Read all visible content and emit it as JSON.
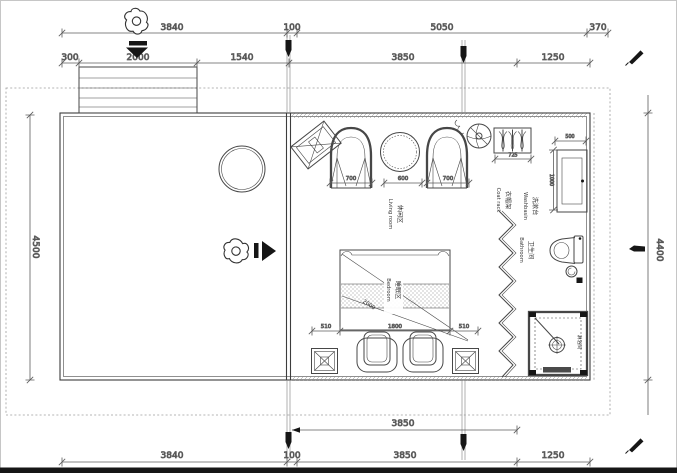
{
  "drawing": {
    "type": "architectural floor plan",
    "ink_color": "#3d3d3d",
    "background": "#ffffff"
  },
  "dims": {
    "top_row1": [
      "3840",
      "100",
      "5050",
      "370"
    ],
    "top_row2": [
      "300",
      "2000",
      "1540",
      "3850",
      "1250"
    ],
    "bottom_inner": [
      "3850"
    ],
    "bottom_row": [
      "3840",
      "100",
      "3850",
      "1250"
    ],
    "left": "4500",
    "right": "4400",
    "living_row": [
      "700",
      "600",
      "700"
    ],
    "coat_rack": "725",
    "washbasin_width": "500",
    "washbasin_depth": "1000",
    "bed_row": [
      "510",
      "1800",
      "510"
    ],
    "bed_diagonal": "2000"
  },
  "rooms": {
    "living": {
      "zh": "休闲区",
      "en": "Living room"
    },
    "bedroom": {
      "zh": "睡眠区",
      "en": "Bedroom"
    },
    "bathroom": {
      "zh": "卫生间",
      "en": "Bathroom"
    },
    "washbasin": {
      "zh": "洗漱台",
      "en": "Washbasin"
    },
    "coat_rack": {
      "zh": "衣帽架",
      "en": "Coat rack"
    },
    "shower": {
      "zh": "淋浴间"
    }
  },
  "icons": {
    "person-top-icon": "top-view person figure",
    "entry-arrow-down-icon": "▼",
    "entry-arrow-right-icon": "▶",
    "fan-icon": "fan symbol",
    "pen-icon": "✎",
    "axis-marker-icon": "plumb marker"
  }
}
